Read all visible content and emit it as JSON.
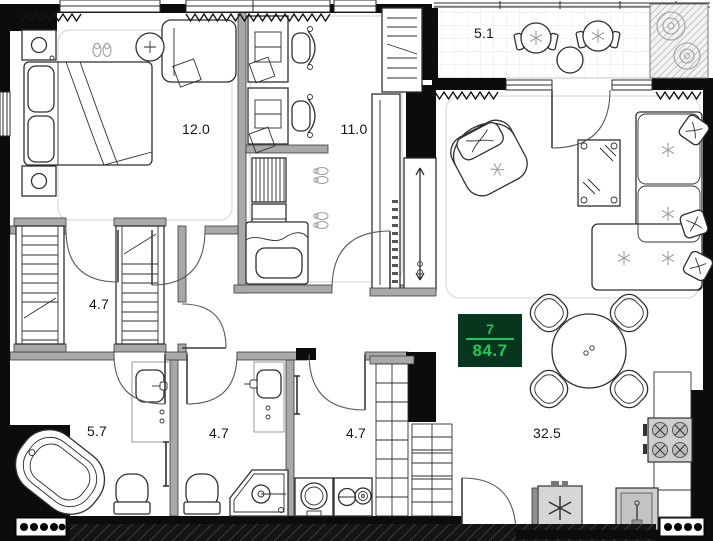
{
  "badge": {
    "unit": "7",
    "area": "84.7",
    "bg_color": "#07351e",
    "text_color": "#1ec95b"
  },
  "rooms": {
    "bedroom": {
      "label": "12.0"
    },
    "kids_room": {
      "label": "11.0"
    },
    "balcony": {
      "label": "5.1"
    },
    "walk_in_closet": {
      "label": "4.7"
    },
    "bathroom_main": {
      "label": "5.7"
    },
    "bathroom_second": {
      "label": "4.7"
    },
    "laundry": {
      "label": "4.7"
    },
    "living_kitchen": {
      "label": "32.5"
    }
  },
  "icons": {
    "snowflake": "six-spoke asterisk",
    "slippers": "paired ovals",
    "vent_dots": "black circles row"
  },
  "colors": {
    "wall_black": "#0c0c0c",
    "wall_gray": "#a9a9a9",
    "line": "#2f2f2f",
    "floor": "#ffffff",
    "badge_bg": "#07351e",
    "badge_green": "#1ec95b"
  }
}
